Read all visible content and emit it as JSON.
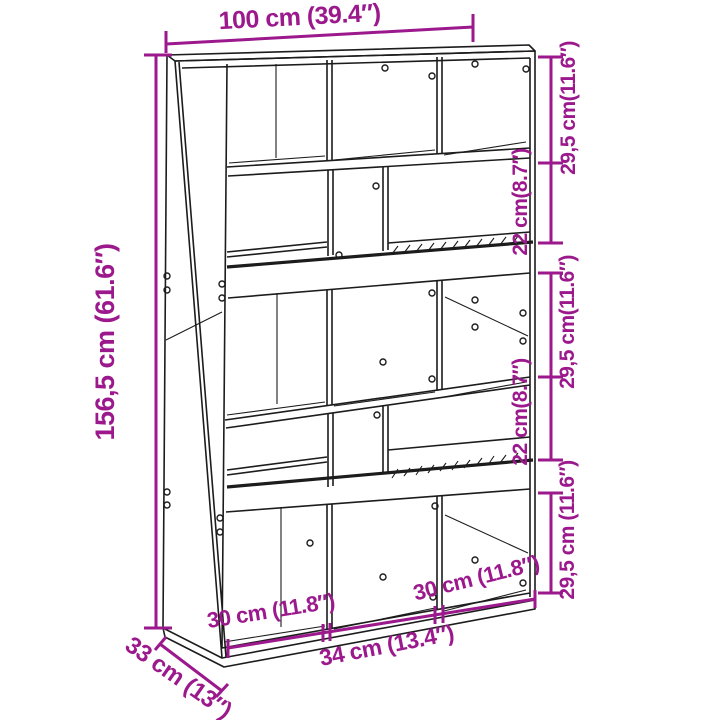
{
  "diagram": {
    "subject": "bookcase-room-divider-dimension-drawing",
    "colors": {
      "dimension": "#9b198c",
      "outline": "#1c1c1c",
      "background": "#ffffff"
    },
    "dimensions": {
      "width_total": "100 cm (39.4″)",
      "height_total": "156,5 cm (61.6″)",
      "depth_total": "33 cm (13″)",
      "right_sections": [
        "29,5 cm(11.6″)",
        "22 cm(8.7″)",
        "29,5 cm(11.6″)",
        "22 cm(8.7″)",
        "29,5 cm (11.6″)"
      ],
      "compartment_widths": [
        "30 cm (11.8″)",
        "34 cm (13.4″)",
        "30 cm (11.8″)"
      ]
    }
  }
}
